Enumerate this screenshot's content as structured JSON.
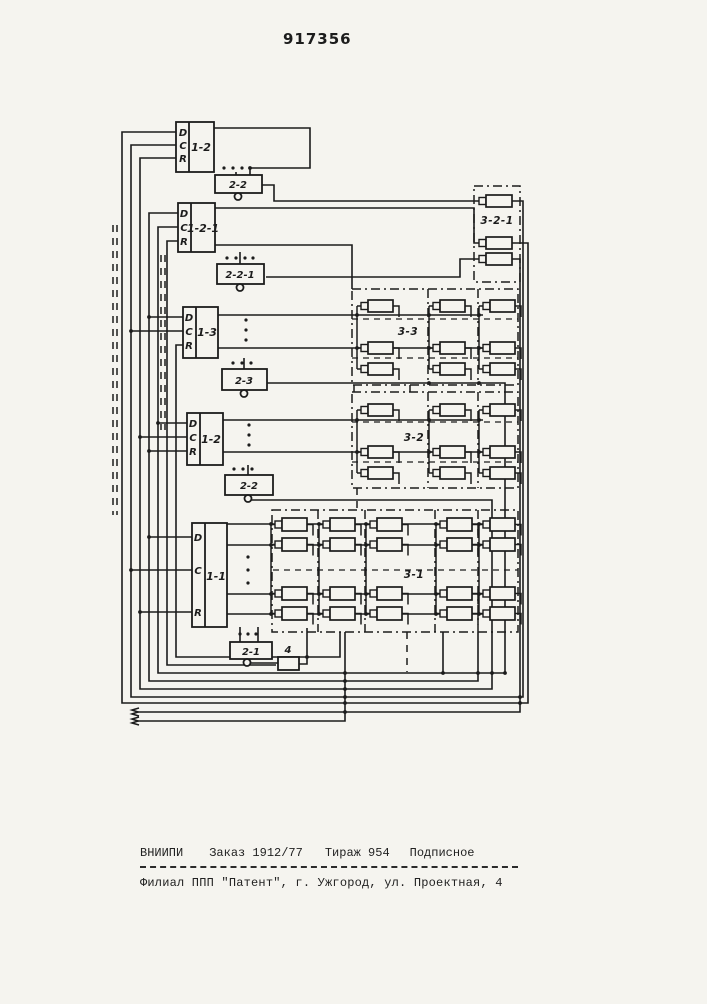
{
  "page": {
    "patent_number": "917356"
  },
  "diagram": {
    "blocks": [
      {
        "id": "b1",
        "label": "1-2",
        "pins": [
          "D",
          "C",
          "R"
        ]
      },
      {
        "id": "b2",
        "label": "1-2-1",
        "pins": [
          "D",
          "C",
          "R"
        ]
      },
      {
        "id": "b3",
        "label": "1-3",
        "pins": [
          "D",
          "C",
          "R"
        ]
      },
      {
        "id": "b4",
        "label": "1-2",
        "pins": [
          "D",
          "C",
          "R"
        ]
      },
      {
        "id": "b5",
        "label": "1-1",
        "pins": [
          "D",
          "C",
          "R"
        ]
      }
    ],
    "subblocks": [
      {
        "label": "2-2"
      },
      {
        "label": "2-2-1"
      },
      {
        "label": "2-3"
      },
      {
        "label": "2-2"
      },
      {
        "label": "2-1"
      }
    ],
    "delay_block": {
      "label": "4"
    },
    "matrix_groups": [
      {
        "label": "3-2-1"
      },
      {
        "label": "3-3"
      },
      {
        "label": "3-2"
      },
      {
        "label": "3-1"
      }
    ]
  },
  "footer": {
    "institute": "ВНИИПИ",
    "order": "Заказ 1912/77",
    "print_run": "Тираж 954",
    "subscription": "Подписное",
    "branch_line": "Филиал ППП \"Патент\", г. Ужгород, ул. Проектная, 4"
  },
  "ink_color": "#1c1c1c",
  "paper_color": "#f5f4ef"
}
